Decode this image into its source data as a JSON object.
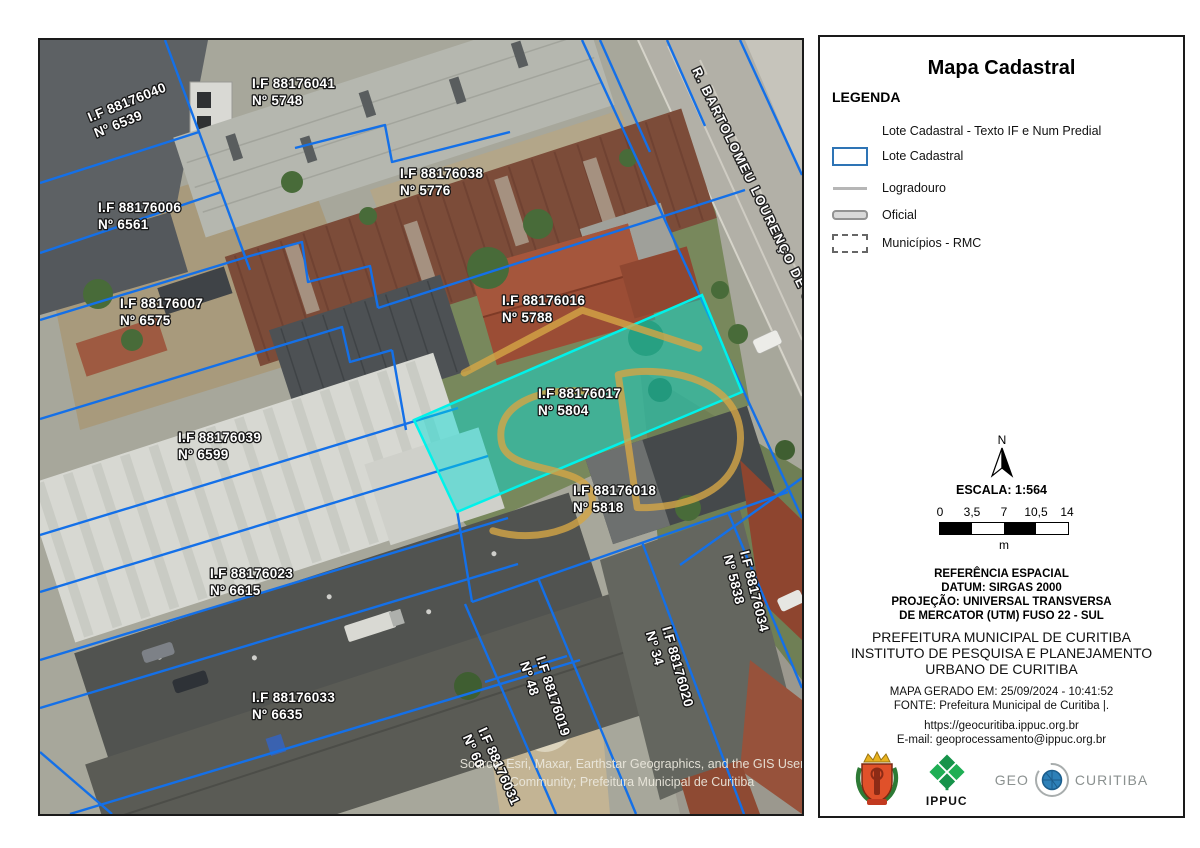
{
  "map": {
    "street_label": "R. BARTOLOMEU LOURENÇO DE GUSMÃO",
    "attribution_line1": "Source: Esri, Maxar, Earthstar Geographics, and the GIS User",
    "attribution_line2": "Community; Prefeitura Municipal de Curitiba",
    "highlighted_lot": "I.F 88176017",
    "lots": [
      {
        "if": "I.F 88176040",
        "num": "Nº 6539"
      },
      {
        "if": "I.F 88176041",
        "num": "Nº 5748"
      },
      {
        "if": "I.F 88176038",
        "num": "Nº 5776"
      },
      {
        "if": "I.F 88176006",
        "num": "Nº 6561"
      },
      {
        "if": "I.F 88176007",
        "num": "Nº 6575"
      },
      {
        "if": "I.F 88176016",
        "num": "Nº 5788"
      },
      {
        "if": "I.F 88176017",
        "num": "Nº 5804"
      },
      {
        "if": "I.F 88176018",
        "num": "Nº 5818"
      },
      {
        "if": "I.F 88176039",
        "num": "Nº 6599"
      },
      {
        "if": "I.F 88176023",
        "num": "Nº 6615"
      },
      {
        "if": "I.F 88176033",
        "num": "Nº 6635"
      },
      {
        "if": "I.F 88176019",
        "num": "Nº 48"
      },
      {
        "if": "I.F 88176020",
        "num": "Nº 34"
      },
      {
        "if": "I.F 88176034",
        "num": "Nº 5838"
      },
      {
        "if": "I.F 88176031",
        "num": "Nº 60"
      }
    ]
  },
  "panel": {
    "title": "Mapa Cadastral",
    "legend": {
      "heading": "LEGENDA",
      "items": [
        {
          "label": "Lote Cadastral - Texto IF e Num Predial"
        },
        {
          "label": "Lote Cadastral"
        },
        {
          "label": "Logradouro"
        },
        {
          "label": "Oficial"
        },
        {
          "label": "Municípios - RMC"
        }
      ]
    },
    "north_label": "N",
    "scale_text": "ESCALA: 1:564",
    "scalebar": {
      "ticks": [
        "0",
        "3,5",
        "7",
        "10,5",
        "14"
      ],
      "unit": "m"
    },
    "reference": {
      "l1": "REFERÊNCIA ESPACIAL",
      "l2": "DATUM: SIRGAS 2000",
      "l3": "PROJEÇÃO: UNIVERSAL TRANSVERSA",
      "l4": "DE MERCATOR (UTM) FUSO 22 - SUL"
    },
    "org": {
      "l1": "PREFEITURA MUNICIPAL DE CURITIBA",
      "l2": "INSTITUTO DE PESQUISA E PLANEJAMENTO",
      "l3": "URBANO DE CURITIBA"
    },
    "generated": "MAPA GERADO EM: 25/09/2024 - 10:41:52",
    "fonte": "FONTE: Prefeitura Municipal de Curitiba |.",
    "url": "https://geocuritiba.ippuc.org.br",
    "email": "E-mail: geoprocessamento@ippuc.org.br",
    "logos": {
      "ippuc": "IPPUC",
      "geo": "GEO",
      "curitiba": "CURITIBA"
    }
  },
  "colors": {
    "lot_line": "#1470e8",
    "highlight_fill": "#00e2dc",
    "legend_blue": "#2e74b5",
    "watermark_gold": "#d5a646"
  }
}
